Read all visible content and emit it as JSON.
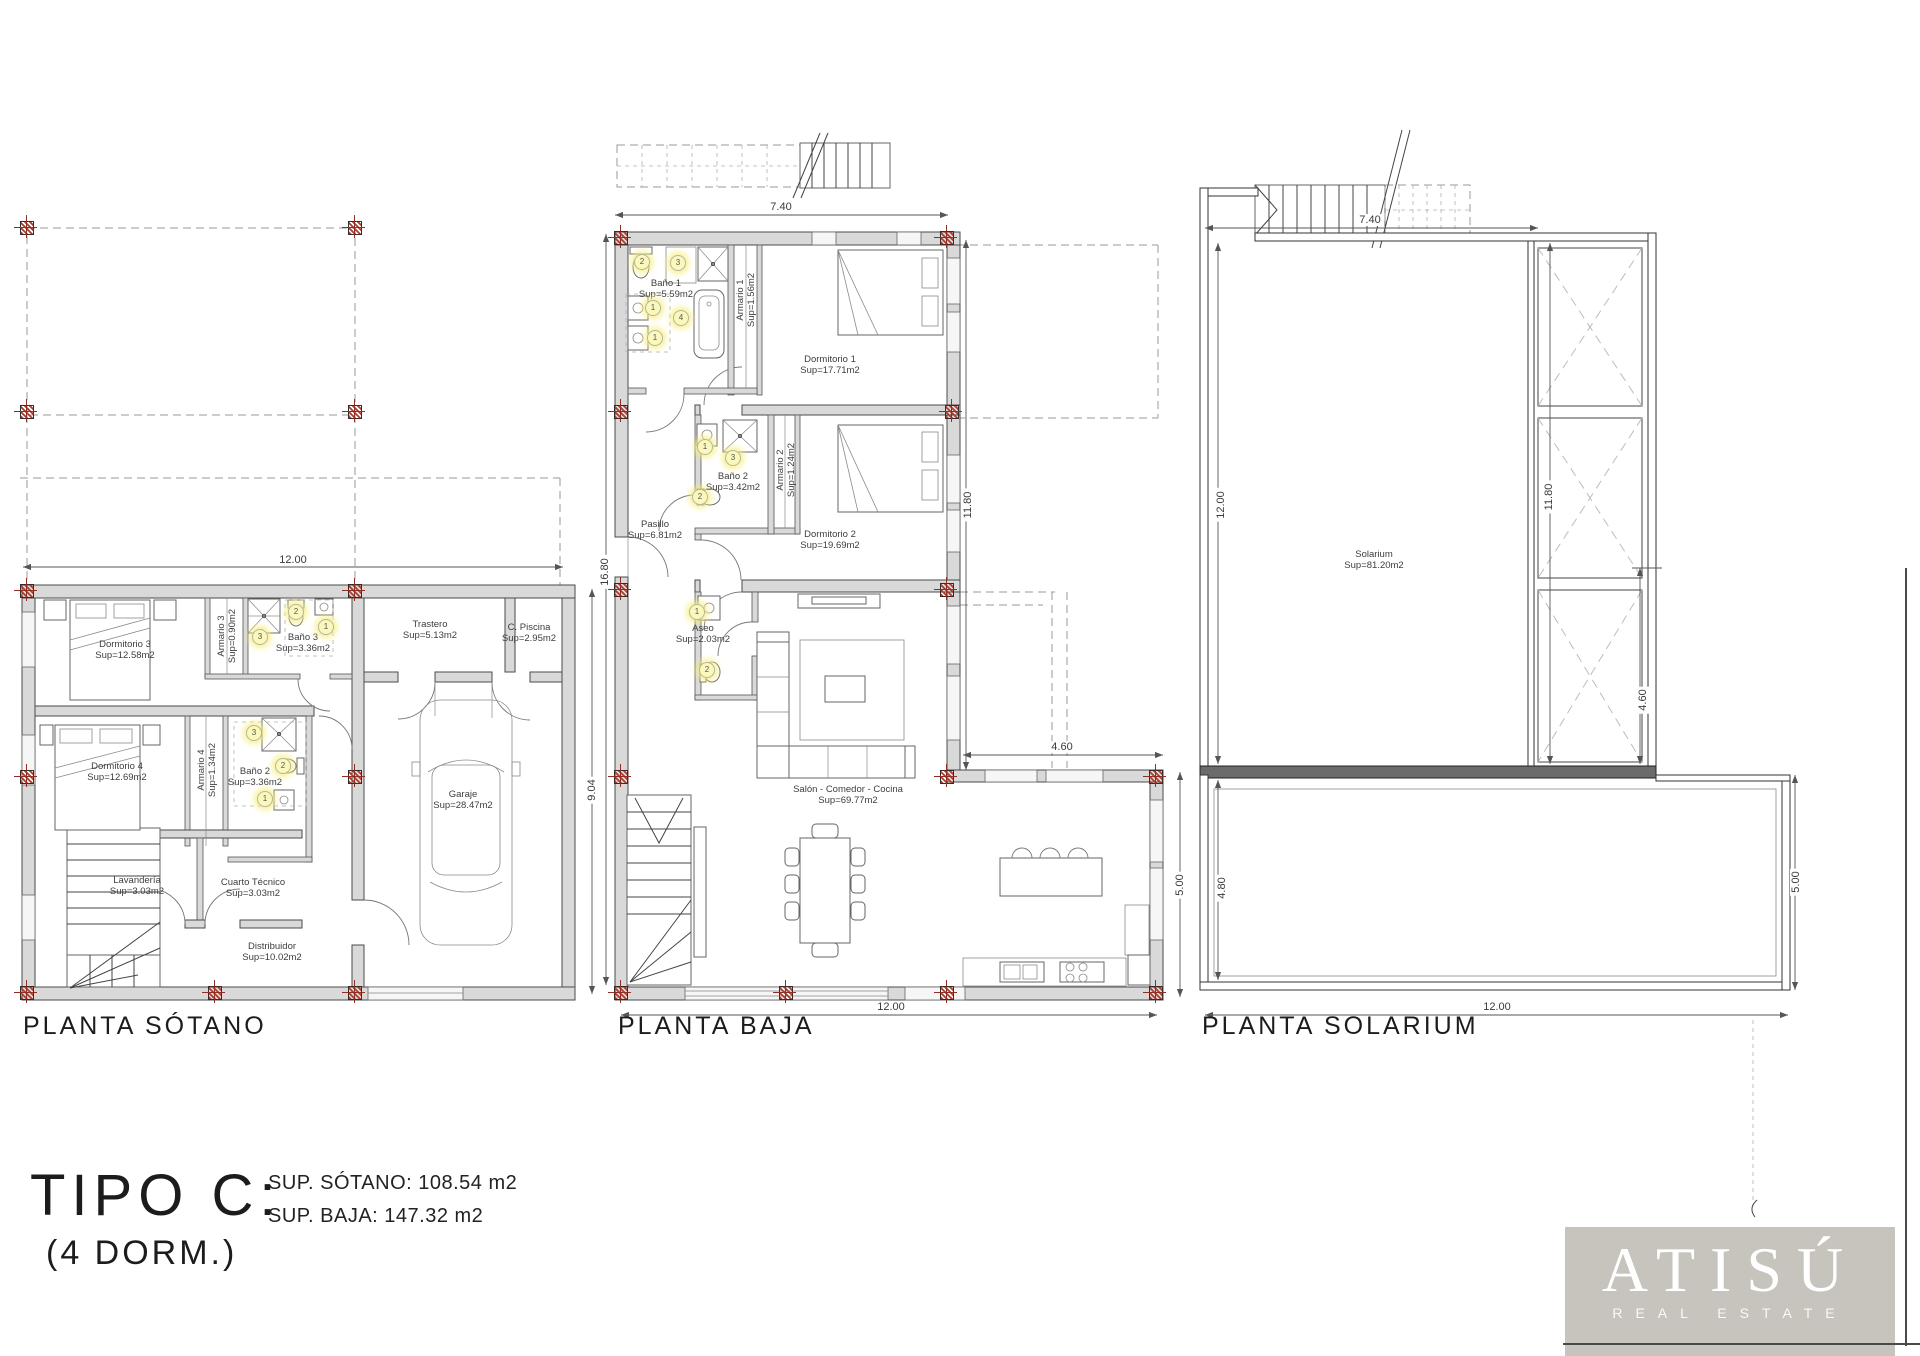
{
  "footer": {
    "type_title": "TIPO C:",
    "type_subtitle": "(4 DORM.)",
    "sup_sotano": "SUP. SÓTANO: 108.54 m2",
    "sup_baja": "SUP. BAJA: 147.32 m2"
  },
  "logo": {
    "name": "ATISÚ",
    "tagline": "REAL ESTATE",
    "bg_color": "#c7c3bd",
    "text_color": "#ffffff"
  },
  "colors": {
    "wall_fill": "#d9d9d9",
    "line": "#4a4a4a",
    "column_marker": "#b23c2e",
    "fixture_fill": "#fbf8bb"
  },
  "plans": [
    {
      "id": "sotano",
      "title": "PLANTA SÓTANO",
      "title_x": 23,
      "title_y": 1012,
      "rooms": [
        {
          "label": "Dormitorio 3",
          "area": "Sup=12.58m2",
          "x": 125,
          "y": 650
        },
        {
          "label": "Armario 3",
          "area": "Sup=0.90m2",
          "x": 227,
          "y": 636,
          "rot": true
        },
        {
          "label": "Baño 3",
          "area": "Sup=3.36m2",
          "x": 303,
          "y": 643
        },
        {
          "label": "Trastero",
          "area": "Sup=5.13m2",
          "x": 430,
          "y": 630
        },
        {
          "label": "C. Piscina",
          "area": "Sup=2.95m2",
          "x": 529,
          "y": 633
        },
        {
          "label": "Dormitorio 4",
          "area": "Sup=12.69m2",
          "x": 117,
          "y": 772
        },
        {
          "label": "Armario 4",
          "area": "Sup=1.34m2",
          "x": 207,
          "y": 770,
          "rot": true
        },
        {
          "label": "Baño 2",
          "area": "Sup=3.36m2",
          "x": 255,
          "y": 777
        },
        {
          "label": "Lavandería",
          "area": "Sup=3.03m2",
          "x": 137,
          "y": 886
        },
        {
          "label": "Cuarto Técnico",
          "area": "Sup=3.03m2",
          "x": 253,
          "y": 888
        },
        {
          "label": "Distribuidor",
          "area": "Sup=10.02m2",
          "x": 272,
          "y": 952
        },
        {
          "label": "Garaje",
          "area": "Sup=28.47m2",
          "x": 463,
          "y": 800
        }
      ],
      "dims": [
        {
          "text": "12.00",
          "x": 293,
          "y": 560
        },
        {
          "text": "9.04",
          "x": 592,
          "y": 790,
          "rot": true
        }
      ],
      "fixtures": [
        {
          "n": "2",
          "x": 296,
          "y": 612
        },
        {
          "n": "1",
          "x": 326,
          "y": 627
        },
        {
          "n": "3",
          "x": 260,
          "y": 637
        },
        {
          "n": "3",
          "x": 254,
          "y": 733
        },
        {
          "n": "2",
          "x": 283,
          "y": 766
        },
        {
          "n": "1",
          "x": 265,
          "y": 799
        }
      ],
      "columns": [
        [
          27,
          228
        ],
        [
          355,
          228
        ],
        [
          27,
          412
        ],
        [
          355,
          412
        ],
        [
          27,
          591
        ],
        [
          355,
          591
        ],
        [
          27,
          777
        ],
        [
          355,
          777
        ],
        [
          27,
          993
        ],
        [
          215,
          993
        ],
        [
          355,
          993
        ]
      ]
    },
    {
      "id": "baja",
      "title": "PLANTA BAJA",
      "title_x": 618,
      "title_y": 1012,
      "rooms": [
        {
          "label": "Baño 1",
          "area": "Sup=5.59m2",
          "x": 666,
          "y": 289
        },
        {
          "label": "Armario 1",
          "area": "Sup=1.56m2",
          "x": 746,
          "y": 300,
          "rot": true
        },
        {
          "label": "Dormitorio 1",
          "area": "Sup=17.71m2",
          "x": 830,
          "y": 365
        },
        {
          "label": "Baño 2",
          "area": "Sup=3.42m2",
          "x": 733,
          "y": 482
        },
        {
          "label": "Armario 2",
          "area": "Sup=1.24m2",
          "x": 786,
          "y": 470,
          "rot": true
        },
        {
          "label": "Dormitorio 2",
          "area": "Sup=19.69m2",
          "x": 830,
          "y": 540
        },
        {
          "label": "Pasillo",
          "area": "Sup=6.81m2",
          "x": 655,
          "y": 530
        },
        {
          "label": "Aseo",
          "area": "Sup=2.03m2",
          "x": 703,
          "y": 634
        },
        {
          "label": "Salón - Comedor - Cocina",
          "area": "Sup=69.77m2",
          "x": 848,
          "y": 795
        },
        {
          "label": "",
          "area": "",
          "x": 0,
          "y": 0
        }
      ],
      "dims": [
        {
          "text": "7.40",
          "x": 781,
          "y": 207
        },
        {
          "text": "16.80",
          "x": 605,
          "y": 572,
          "rot": true
        },
        {
          "text": "11.80",
          "x": 968,
          "y": 505,
          "rot": true
        },
        {
          "text": "4.60",
          "x": 1062,
          "y": 747
        },
        {
          "text": "5.00",
          "x": 1180,
          "y": 885,
          "rot": true
        },
        {
          "text": "12.00",
          "x": 891,
          "y": 1007
        }
      ],
      "fixtures": [
        {
          "n": "2",
          "x": 642,
          "y": 262
        },
        {
          "n": "3",
          "x": 678,
          "y": 263
        },
        {
          "n": "1",
          "x": 653,
          "y": 308
        },
        {
          "n": "4",
          "x": 681,
          "y": 318
        },
        {
          "n": "1",
          "x": 655,
          "y": 338
        },
        {
          "n": "1",
          "x": 705,
          "y": 447
        },
        {
          "n": "3",
          "x": 733,
          "y": 458
        },
        {
          "n": "2",
          "x": 700,
          "y": 497
        },
        {
          "n": "1",
          "x": 697,
          "y": 612
        },
        {
          "n": "2",
          "x": 707,
          "y": 670
        }
      ],
      "columns": [
        [
          621,
          238
        ],
        [
          947,
          238
        ],
        [
          621,
          412
        ],
        [
          952,
          412
        ],
        [
          621,
          590
        ],
        [
          947,
          590
        ],
        [
          621,
          777
        ],
        [
          947,
          777
        ],
        [
          1156,
          777
        ],
        [
          621,
          993
        ],
        [
          786,
          993
        ],
        [
          947,
          993
        ],
        [
          1156,
          993
        ]
      ]
    },
    {
      "id": "solarium",
      "title": "PLANTA SOLARIUM",
      "title_x": 1202,
      "title_y": 1012,
      "rooms": [
        {
          "label": "Solarium",
          "area": "Sup=81.20m2",
          "x": 1374,
          "y": 560
        }
      ],
      "dims": [
        {
          "text": "7.40",
          "x": 1370,
          "y": 220
        },
        {
          "text": "12.00",
          "x": 1221,
          "y": 505,
          "rot": true
        },
        {
          "text": "11.80",
          "x": 1549,
          "y": 497,
          "rot": true
        },
        {
          "text": "4.60",
          "x": 1643,
          "y": 700,
          "rot": true
        },
        {
          "text": "4.80",
          "x": 1222,
          "y": 888,
          "rot": true
        },
        {
          "text": "5.00",
          "x": 1796,
          "y": 882,
          "rot": true
        },
        {
          "text": "12.00",
          "x": 1497,
          "y": 1007
        }
      ],
      "fixtures": [],
      "columns": []
    }
  ]
}
